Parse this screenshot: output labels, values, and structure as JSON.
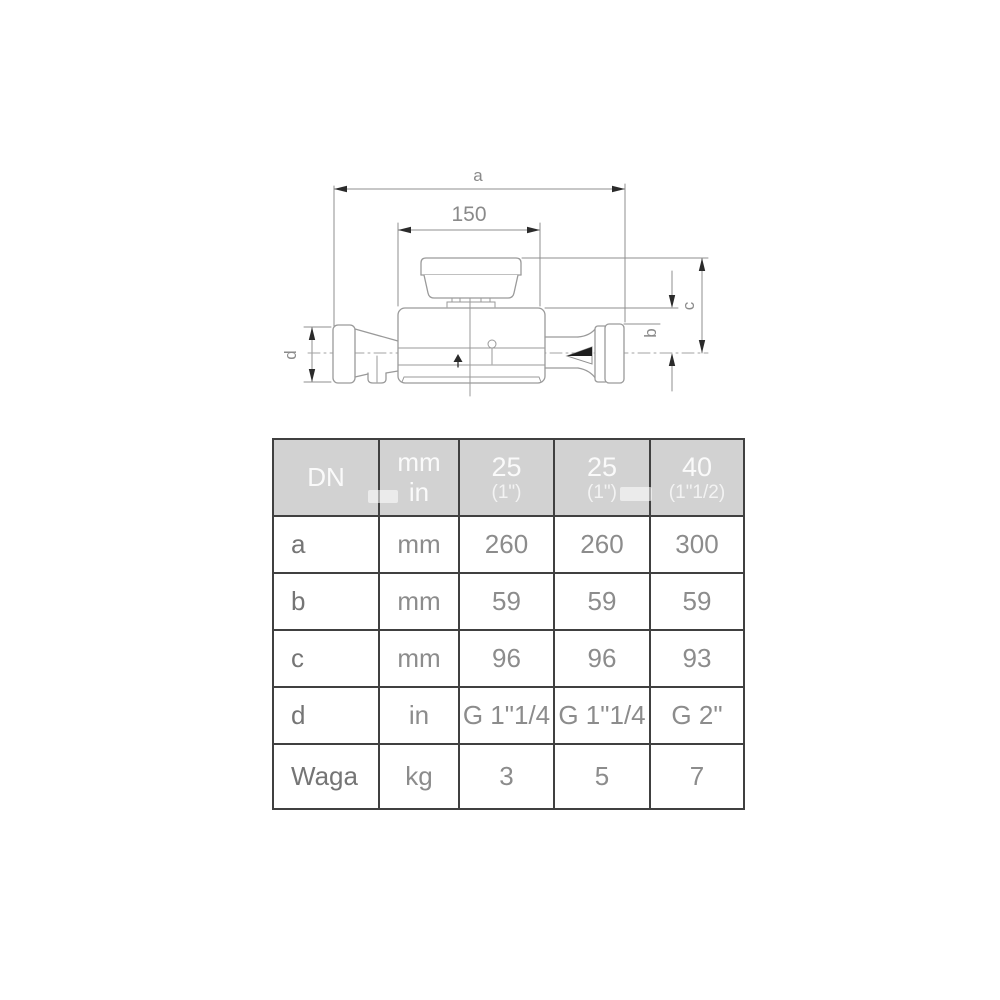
{
  "page": {
    "background": "#ffffff"
  },
  "diagram": {
    "description": "single-jet water meter side view technical drawing",
    "labels": {
      "a": "a",
      "len150": "150",
      "b": "b",
      "c": "c",
      "d": "d"
    },
    "colors": {
      "drawing_line": "#9a9a9a",
      "dimension_line": "#8f8f8f",
      "arrowhead": "#2b2b2b",
      "label_text": "#8a8a8a"
    }
  },
  "table": {
    "colors": {
      "border": "#404040",
      "header_bg": "#d2d2d2",
      "header_text": "#fafafa",
      "label_text": "#757575",
      "value_text": "#8c8c8c",
      "cell_bg": "#ffffff"
    },
    "header": {
      "dn": "DN",
      "unit_top": "mm",
      "unit_bottom": "in",
      "variants": [
        {
          "dn": "25",
          "thread": "(1\")"
        },
        {
          "dn": "25",
          "thread": "(1\")"
        },
        {
          "dn": "40",
          "thread": "(1\"1/2)"
        }
      ]
    },
    "rows": [
      {
        "label": "a",
        "unit": "mm",
        "values": [
          "260",
          "260",
          "300"
        ]
      },
      {
        "label": "b",
        "unit": "mm",
        "values": [
          "59",
          "59",
          "59"
        ]
      },
      {
        "label": "c",
        "unit": "mm",
        "values": [
          "96",
          "96",
          "93"
        ]
      },
      {
        "label": "d",
        "unit": "in",
        "values": [
          "G 1\"1/4",
          "G 1\"1/4",
          "G 2\""
        ]
      },
      {
        "label": "Waga",
        "unit": "kg",
        "values": [
          "3",
          "5",
          "7"
        ]
      }
    ]
  }
}
